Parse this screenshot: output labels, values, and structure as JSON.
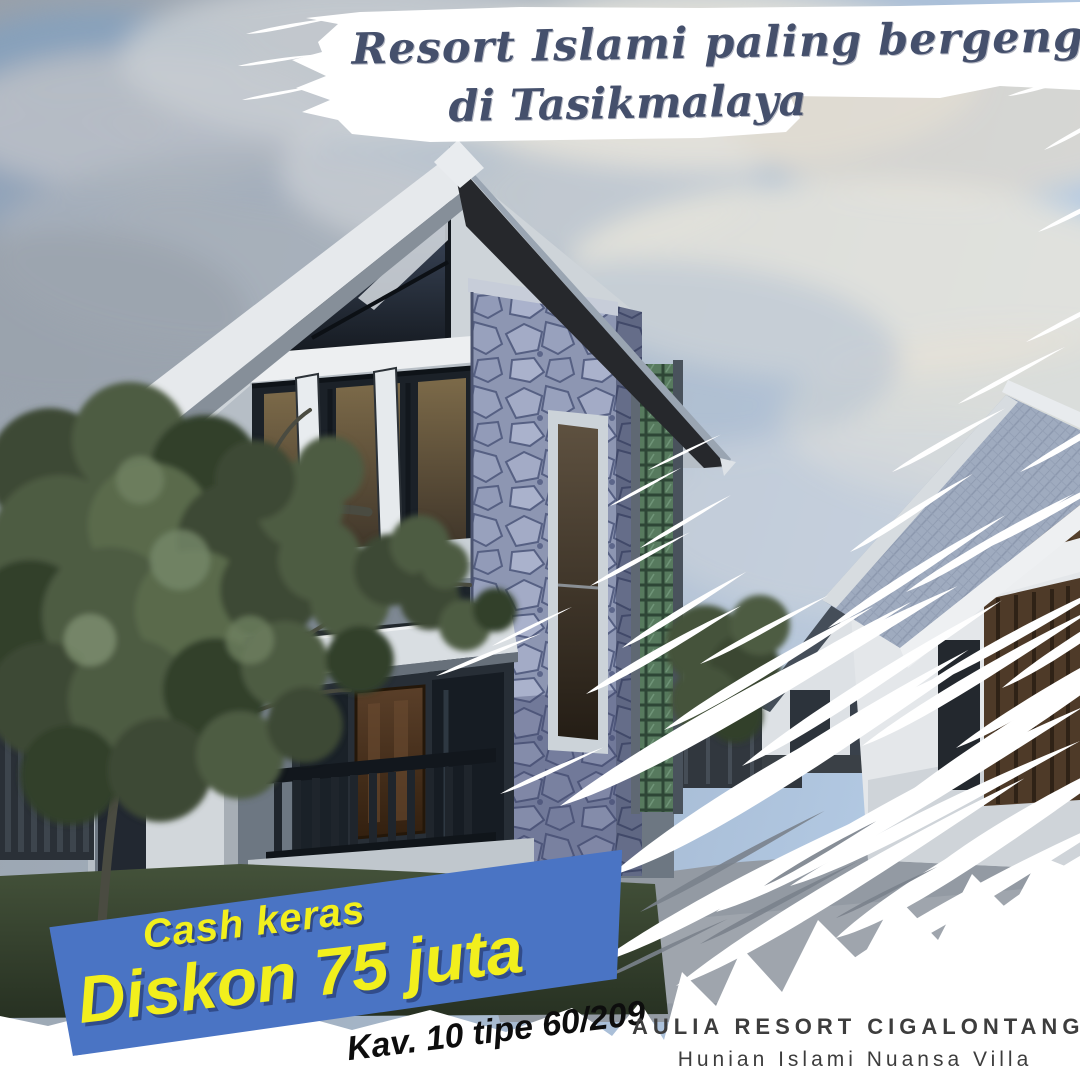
{
  "poster": {
    "headline": {
      "line1": "Resort Islami paling bergengsi",
      "line2": "di Tasikmalaya",
      "text_color": "#45506c"
    },
    "promo": {
      "kicker": "Cash keras",
      "discount": "Diskon 75 juta",
      "unit": "Kav. 10 tipe 60/209",
      "banner_color": "#4a74c4",
      "text_color": "#f2ef1d"
    },
    "footer": {
      "project_name": "AULIA RESORT CIGALONTANG",
      "tagline": "Hunian Islami Nuansa Villa",
      "text_color": "#3d3d3d"
    }
  }
}
